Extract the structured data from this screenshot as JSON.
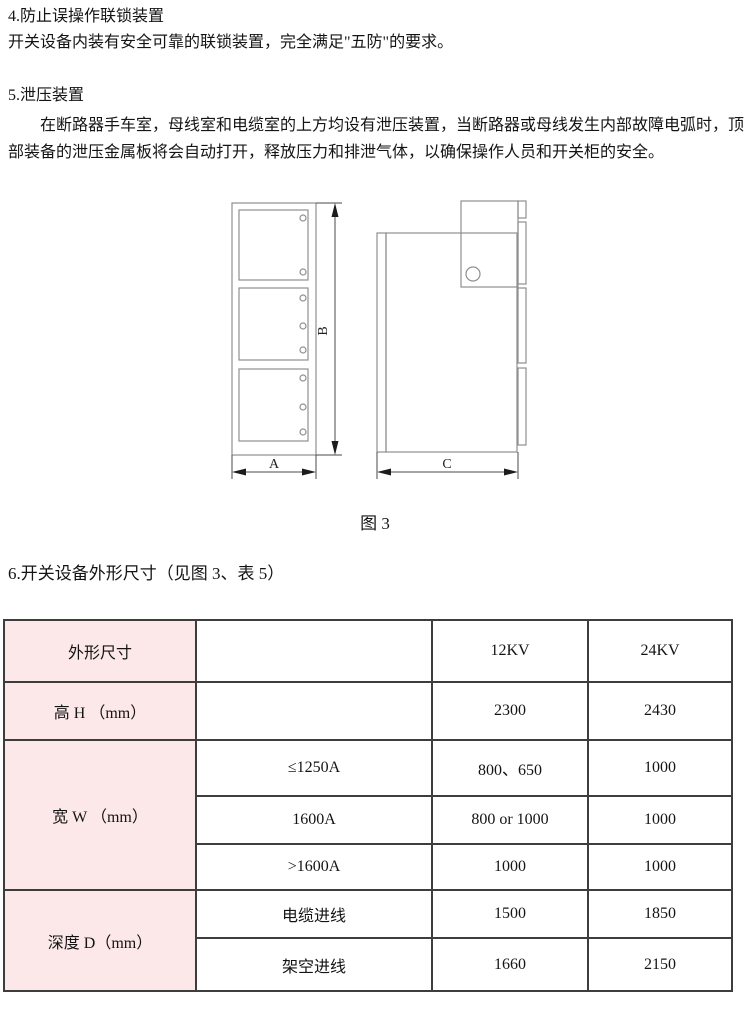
{
  "doc": {
    "s4_heading": "4.防止误操作联锁装置",
    "s4_body": "开关设备内装有安全可靠的联锁装置，完全满足\"五防\"的要求。",
    "s5_heading": "5.泄压装置",
    "s5_body": "在断路器手车室，母线室和电缆室的上方均设有泄压装置，当断路器或母线发生内部故障电弧时，顶部装备的泄压金属板将会自动打开，释放压力和排泄气体，以确保操作人员和开关柜的安全。",
    "fig_caption": "图 3",
    "fig_label_a": "A",
    "fig_label_b": "B",
    "fig_label_c": "C",
    "s6_heading": "6.开关设备外形尺寸（见图 3、表 5）",
    "table": {
      "accent_bg": "#fce8e8",
      "corner": "外形尺寸",
      "col_12kv": "12KV",
      "col_24kv": "24KV",
      "height_label": "高 H （mm）",
      "height_12kv": "2300",
      "height_24kv": "2430",
      "width_label": "宽 W （mm）",
      "width_rows": [
        {
          "condition": "≤1250A",
          "kv12": "800、650",
          "kv24": "1000"
        },
        {
          "condition": "1600A",
          "kv12": "800 or 1000",
          "kv24": "1000"
        },
        {
          "condition": ">1600A",
          "kv12": "1000",
          "kv24": "1000"
        }
      ],
      "depth_label": "深度 D（mm）",
      "depth_rows": [
        {
          "condition": "电缆进线",
          "kv12": "1500",
          "kv24": "1850"
        },
        {
          "condition": "架空进线",
          "kv12": "1660",
          "kv24": "2150"
        }
      ]
    }
  }
}
